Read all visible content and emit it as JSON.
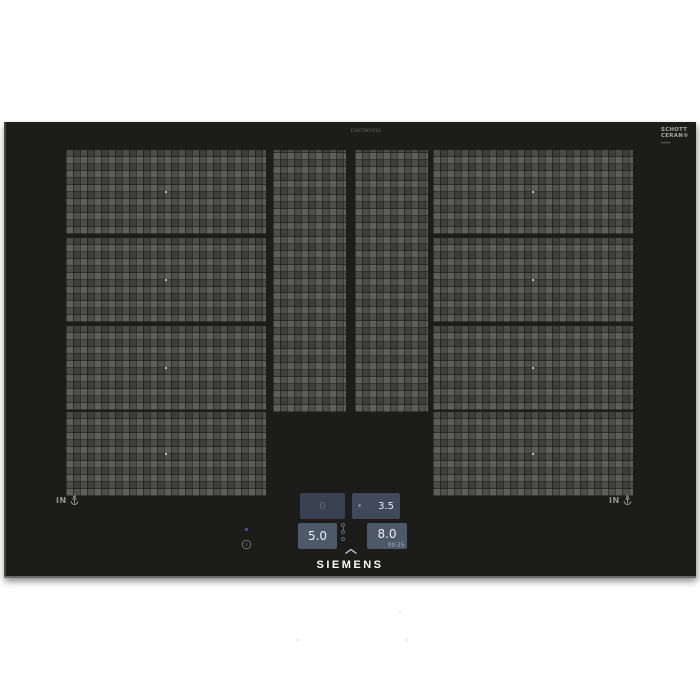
{
  "product": {
    "brand_logo": "SIEMENS",
    "model_label": "EX875KYV1E",
    "glass_brand_line1": "SCHOTT",
    "glass_brand_line2": "CERAN®",
    "induction_marking_left": "IN",
    "induction_marking_right": "IN",
    "info_symbol": "i"
  },
  "control_panel": {
    "tiles": [
      {
        "id": "zone-display-top-left",
        "value": "0",
        "state": "standby"
      },
      {
        "id": "zone-display-top-right",
        "value": "3.5",
        "state": "on"
      },
      {
        "id": "zone-display-bottom-left",
        "value": "5.0",
        "state": "on"
      },
      {
        "id": "zone-display-bottom-right",
        "value": "8.0",
        "timer": "00:25",
        "state": "on"
      }
    ],
    "icons": [
      "key-icon",
      "pause-icon",
      "timer-icon",
      "chevron-up-icon"
    ]
  },
  "markings": {
    "zone_dots_count": 8
  },
  "colors": {
    "page_background": "#ffffff",
    "glass_surface": "#1c1c1a",
    "zone_texture_base": "#4c4c4a",
    "display_tile_standby": "#3a4251",
    "display_tile_active": "#4d5869",
    "digit_bright": "#eef1f6",
    "digit_dim": "#5d687a",
    "timer_text": "#b7bdc7",
    "power_led": "#4b52c4"
  }
}
